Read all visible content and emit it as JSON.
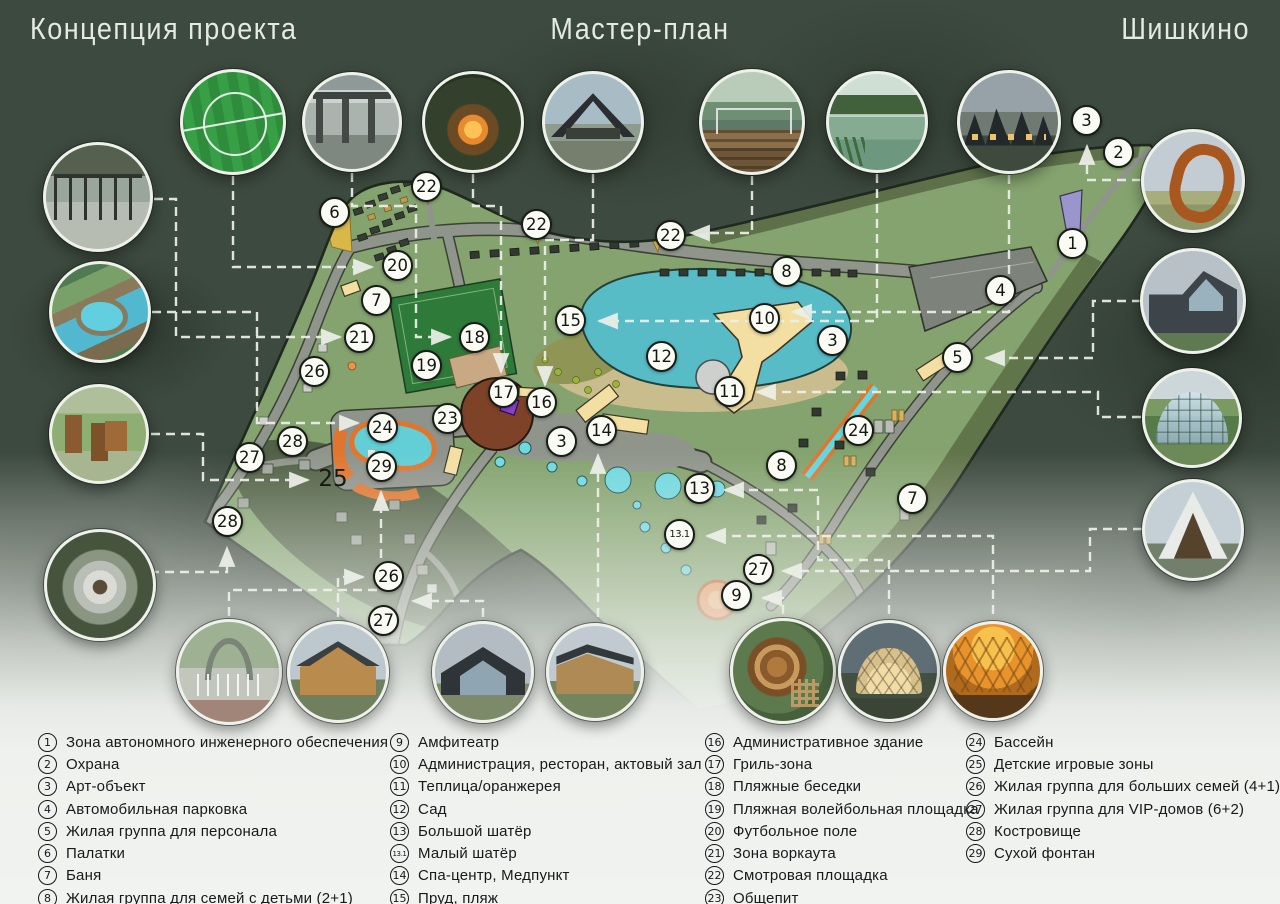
{
  "header": {
    "left": "Концепция проекта",
    "center": "Мастер-план",
    "right": "Шишкино"
  },
  "map": {
    "plain_labels": [
      {
        "text": "25",
        "x": 333,
        "y": 479
      }
    ],
    "markers": [
      {
        "n": "22",
        "x": 427,
        "y": 187
      },
      {
        "n": "6",
        "x": 335,
        "y": 213
      },
      {
        "n": "22",
        "x": 537,
        "y": 225
      },
      {
        "n": "22",
        "x": 671,
        "y": 236
      },
      {
        "n": "20",
        "x": 398,
        "y": 266
      },
      {
        "n": "8",
        "x": 787,
        "y": 272
      },
      {
        "n": "7",
        "x": 377,
        "y": 301
      },
      {
        "n": "15",
        "x": 571,
        "y": 321
      },
      {
        "n": "10",
        "x": 765,
        "y": 319
      },
      {
        "n": "21",
        "x": 360,
        "y": 338
      },
      {
        "n": "18",
        "x": 475,
        "y": 338
      },
      {
        "n": "3",
        "x": 833,
        "y": 341
      },
      {
        "n": "12",
        "x": 662,
        "y": 357
      },
      {
        "n": "2",
        "x": 1119,
        "y": 153
      },
      {
        "n": "3",
        "x": 1087,
        "y": 121
      },
      {
        "n": "1",
        "x": 1073,
        "y": 244
      },
      {
        "n": "4",
        "x": 1001,
        "y": 291
      },
      {
        "n": "5",
        "x": 958,
        "y": 358
      },
      {
        "n": "26",
        "x": 315,
        "y": 372
      },
      {
        "n": "19",
        "x": 427,
        "y": 366
      },
      {
        "n": "17",
        "x": 504,
        "y": 393
      },
      {
        "n": "16",
        "x": 542,
        "y": 403
      },
      {
        "n": "11",
        "x": 730,
        "y": 392
      },
      {
        "n": "23",
        "x": 448,
        "y": 419
      },
      {
        "n": "24",
        "x": 383,
        "y": 428
      },
      {
        "n": "14",
        "x": 602,
        "y": 431
      },
      {
        "n": "3",
        "x": 562,
        "y": 442
      },
      {
        "n": "28",
        "x": 293,
        "y": 442
      },
      {
        "n": "27",
        "x": 250,
        "y": 458
      },
      {
        "n": "29",
        "x": 382,
        "y": 467
      },
      {
        "n": "8",
        "x": 782,
        "y": 466
      },
      {
        "n": "24",
        "x": 859,
        "y": 431
      },
      {
        "n": "13",
        "x": 700,
        "y": 489
      },
      {
        "n": "7",
        "x": 913,
        "y": 499
      },
      {
        "n": "13.1",
        "x": 680,
        "y": 535
      },
      {
        "n": "28",
        "x": 228,
        "y": 522
      },
      {
        "n": "26",
        "x": 389,
        "y": 577
      },
      {
        "n": "9",
        "x": 737,
        "y": 596
      },
      {
        "n": "27",
        "x": 759,
        "y": 570
      },
      {
        "n": "27",
        "x": 384,
        "y": 621
      }
    ]
  },
  "photos": {
    "items": [
      {
        "name": "football-field",
        "kind": "turf",
        "x": 233,
        "y": 122,
        "r": 53
      },
      {
        "name": "pergola-lounge",
        "kind": "pergola",
        "x": 352,
        "y": 122,
        "r": 50
      },
      {
        "name": "fire-table",
        "kind": "fire",
        "x": 473,
        "y": 122,
        "r": 51
      },
      {
        "name": "dark-pavilion",
        "kind": "pavilion",
        "x": 593,
        "y": 122,
        "r": 51
      },
      {
        "name": "wooden-deck",
        "kind": "deck",
        "x": 752,
        "y": 122,
        "r": 53
      },
      {
        "name": "lake",
        "kind": "lake",
        "x": 877,
        "y": 122,
        "r": 51
      },
      {
        "name": "modern-cabins",
        "kind": "cabins",
        "x": 1009,
        "y": 122,
        "r": 52
      },
      {
        "name": "workout-area",
        "kind": "workout",
        "x": 98,
        "y": 197,
        "r": 55
      },
      {
        "name": "pool-resort",
        "kind": "poolresort",
        "x": 100,
        "y": 312,
        "r": 51
      },
      {
        "name": "kids-playground",
        "kind": "playground",
        "x": 99,
        "y": 434,
        "r": 50
      },
      {
        "name": "fire-pit-circle",
        "kind": "firepitring",
        "x": 100,
        "y": 585,
        "r": 56
      },
      {
        "name": "art-sculpture",
        "kind": "sculpture",
        "x": 1193,
        "y": 181,
        "r": 52
      },
      {
        "name": "gable-house",
        "kind": "gablehouse",
        "x": 1193,
        "y": 301,
        "r": 53
      },
      {
        "name": "glass-dome",
        "kind": "glassdome",
        "x": 1192,
        "y": 418,
        "r": 50
      },
      {
        "name": "a-frame-house",
        "kind": "aframe",
        "x": 1193,
        "y": 530,
        "r": 51
      },
      {
        "name": "dry-fountain-park",
        "kind": "fountainpark",
        "x": 229,
        "y": 672,
        "r": 53
      },
      {
        "name": "wood-cabin",
        "kind": "woodcabin",
        "x": 338,
        "y": 672,
        "r": 51
      },
      {
        "name": "glass-gable-house",
        "kind": "glassgable",
        "x": 483,
        "y": 672,
        "r": 51
      },
      {
        "name": "modern-cabin",
        "kind": "moderncabin",
        "x": 595,
        "y": 672,
        "r": 49
      },
      {
        "name": "amphitheater",
        "kind": "amphi",
        "x": 783,
        "y": 671,
        "r": 53
      },
      {
        "name": "dome-tent",
        "kind": "dometent",
        "x": 889,
        "y": 671,
        "r": 51
      },
      {
        "name": "orange-canopy",
        "kind": "orangetent",
        "x": 993,
        "y": 671,
        "r": 50
      }
    ]
  },
  "legend": {
    "x": [
      38,
      390,
      705,
      966
    ],
    "top": 731,
    "row_h": 22.3,
    "columns": [
      [
        {
          "n": "1",
          "t": "Зона автономного инженерного обеспечения"
        },
        {
          "n": "2",
          "t": "Охрана"
        },
        {
          "n": "3",
          "t": "Арт-объект"
        },
        {
          "n": "4",
          "t": "Автомобильная парковка"
        },
        {
          "n": "5",
          "t": "Жилая группа для персонала"
        },
        {
          "n": "6",
          "t": "Палатки"
        },
        {
          "n": "7",
          "t": "Баня"
        },
        {
          "n": "8",
          "t": "Жилая группа для семей с детьми (2+1)"
        }
      ],
      [
        {
          "n": "9",
          "t": "Амфитеатр"
        },
        {
          "n": "10",
          "t": "Администрация, ресторан, актовый зал"
        },
        {
          "n": "11",
          "t": "Теплица/оранжерея"
        },
        {
          "n": "12",
          "t": "Сад"
        },
        {
          "n": "13",
          "t": "Большой шатёр"
        },
        {
          "n": "13.1",
          "t": "Малый шатёр"
        },
        {
          "n": "14",
          "t": "Спа-центр, Медпункт"
        },
        {
          "n": "15",
          "t": "Пруд, пляж"
        }
      ],
      [
        {
          "n": "16",
          "t": "Административное здание"
        },
        {
          "n": "17",
          "t": "Гриль-зона"
        },
        {
          "n": "18",
          "t": "Пляжные беседки"
        },
        {
          "n": "19",
          "t": "Пляжная волейбольная площадка"
        },
        {
          "n": "20",
          "t": "Футбольное поле"
        },
        {
          "n": "21",
          "t": "Зона воркаута"
        },
        {
          "n": "22",
          "t": "Смотровая площадка"
        },
        {
          "n": "23",
          "t": "Общепит"
        }
      ],
      [
        {
          "n": "24",
          "t": "Бассейн"
        },
        {
          "n": "25",
          "t": "Детские игровые зоны"
        },
        {
          "n": "26",
          "t": "Жилая группа для больших семей (4+1)"
        },
        {
          "n": "27",
          "t": "Жилая группа для VIP-домов (6+2)"
        },
        {
          "n": "28",
          "t": "Костровище"
        },
        {
          "n": "29",
          "t": "Сухой фонтан"
        }
      ]
    ]
  },
  "colors": {
    "background": "#3d4a3f",
    "site_green": "#84a36e",
    "road_gray": "#90958c",
    "water_teal": "#58bcc6",
    "building_yellow": "#f3dfa2",
    "accent_orange": "#e0762e",
    "marker_fill": "#fbfbf5",
    "line_white": "#eef1ea"
  }
}
